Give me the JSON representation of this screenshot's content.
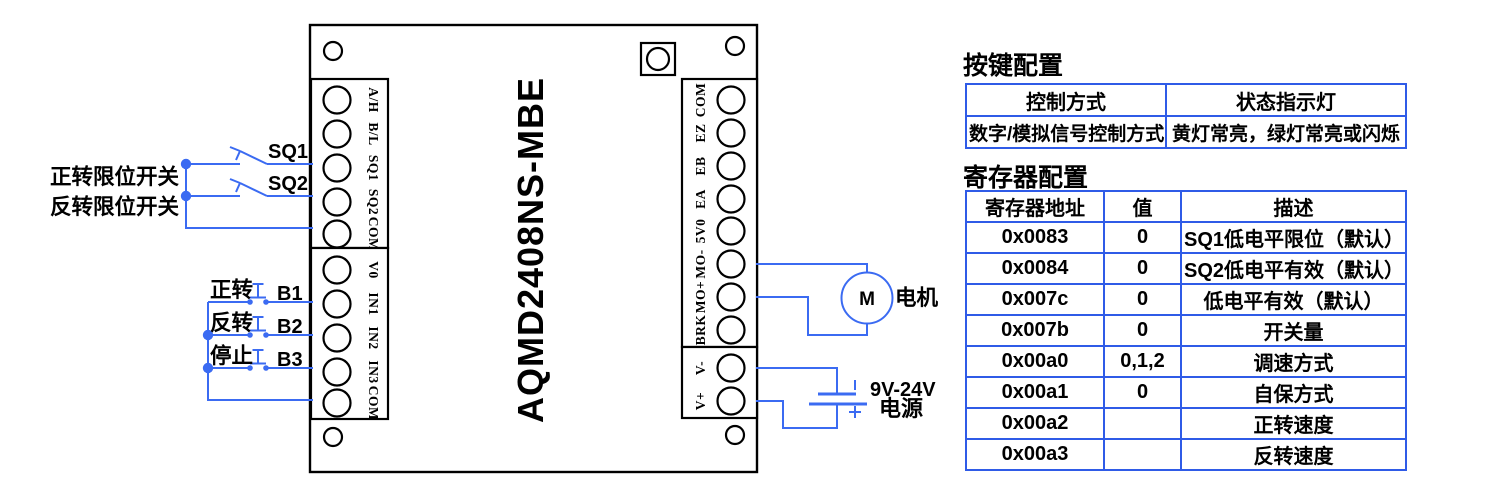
{
  "colors": {
    "wire": "#3b6bf2",
    "table_border": "#2f5be7",
    "text": "#000000"
  },
  "board": {
    "title": "AQMD2408NS-MBE",
    "left_terminal_block1": [
      "A/H",
      "B/L",
      "SQ1",
      "SQ2",
      "COM"
    ],
    "left_terminal_block2": [
      "V0",
      "IN1",
      "IN2",
      "IN3",
      "COM"
    ],
    "right_terminal_block1": [
      "COM",
      "EZ",
      "EB",
      "EA",
      "5V0",
      "MO-",
      "MO+",
      "BRK"
    ],
    "right_terminal_block2": [
      "V-",
      "V+"
    ]
  },
  "wiring": {
    "forward_limit_label": "正转限位开关",
    "reverse_limit_label": "反转限位开关",
    "sq1": "SQ1",
    "sq2": "SQ2",
    "btn_forward": "正转",
    "btn_reverse": "反转",
    "btn_stop": "停止",
    "b1": "B1",
    "b2": "B2",
    "b3": "B3",
    "motor_m": "M",
    "motor_label": "电机",
    "power_voltage": "9V-24V",
    "power_label": "电源"
  },
  "key_table": {
    "title": "按键配置",
    "headers": [
      "控制方式",
      "状态指示灯"
    ],
    "rows": [
      [
        "数字/模拟信号控制方式",
        "黄灯常亮，绿灯常亮或闪烁"
      ]
    ]
  },
  "register_table": {
    "title": "寄存器配置",
    "headers": [
      "寄存器地址",
      "值",
      "描述"
    ],
    "rows": [
      {
        "address": "0x0083",
        "value": "0",
        "desc": "SQ1低电平限位（默认）"
      },
      {
        "address": "0x0084",
        "value": "0",
        "desc": "SQ2低电平有效（默认）"
      },
      {
        "address": "0x007c",
        "value": "0",
        "desc": "低电平有效（默认）"
      },
      {
        "address": "0x007b",
        "value": "0",
        "desc": "开关量"
      },
      {
        "address": "0x00a0",
        "value": "0,1,2",
        "desc": "调速方式"
      },
      {
        "address": "0x00a1",
        "value": "0",
        "desc": "自保方式"
      },
      {
        "address": "0x00a2",
        "value": "",
        "desc": "正转速度"
      },
      {
        "address": "0x00a3",
        "value": "",
        "desc": "反转速度"
      }
    ]
  }
}
